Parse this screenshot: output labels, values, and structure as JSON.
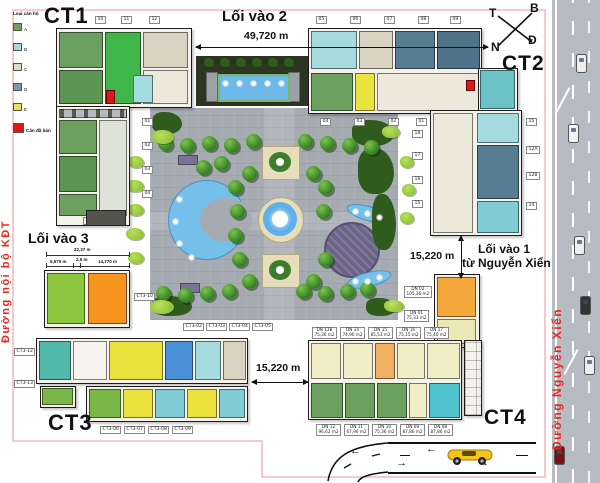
{
  "labels": {
    "ct1": "CT1",
    "ct2": "CT2",
    "ct3": "CT3",
    "ct4": "CT4"
  },
  "legend": {
    "title": "Loại căn hộ",
    "items": [
      {
        "label": "A",
        "color": "#6ca05e"
      },
      {
        "label": "B",
        "color": "#a5dade"
      },
      {
        "label": "C",
        "color": "#cfe0c4"
      },
      {
        "label": "D",
        "color": "#7d98a8"
      },
      {
        "label": "E",
        "color": "#e8e05a"
      },
      {
        "label": "Căn đã bán",
        "color": "#e01814"
      }
    ]
  },
  "compass": {
    "west": "T",
    "north": "B",
    "south": "N",
    "east": "Đ"
  },
  "streets": {
    "internal": "Đường nội bộ KĐT",
    "main": "Đường Nguyễn Xiển"
  },
  "entrances": {
    "e2": "Lối vào 2",
    "e3": "Lối vào 3",
    "e1_line1": "Lối vào 1",
    "e1_line2": "từ Nguyễn Xiển"
  },
  "dimensions": {
    "top_width": "49,720 m",
    "right_gap": "15,220 m",
    "bottom_gap": "15,220 m",
    "ct3_total": "22,37 m",
    "ct3_a": "5,570 m",
    "ct3_b": "2,5 m",
    "ct3_c": "14,770 m"
  },
  "ct1": {
    "right_chips": [
      "01",
      "02",
      "03",
      "04"
    ],
    "top_chips": [
      "10",
      "11",
      "12"
    ]
  },
  "ct2": {
    "top_chips": [
      "05",
      "06",
      "07",
      "08",
      "09"
    ],
    "bottom_chips": [
      "04",
      "03",
      "02",
      "01"
    ],
    "left_chips": [
      "18",
      "17",
      "16",
      "15"
    ],
    "right_chips": [
      "15",
      "12A",
      "12B",
      "14"
    ]
  },
  "ct3": {
    "left_chips": [
      "CT3-12",
      "CT3-13"
    ],
    "top_chips": [
      "CT3-02",
      "CT3-03",
      "CT3-04",
      "CT3-05"
    ],
    "bottom_chips": [
      "CT3-06",
      "CT3-07",
      "CT3-08",
      "CT3-09"
    ],
    "right_chip": "CT3-10"
  },
  "ct4": {
    "top_chips": [
      {
        "name": "DN 12B",
        "area": "75,36 m2"
      },
      {
        "name": "DN 14",
        "area": "74,90 m2"
      },
      {
        "name": "DN 15",
        "area": "85,53 m2"
      },
      {
        "name": "DN 16",
        "area": "75,15 m2"
      },
      {
        "name": "DN 17",
        "area": "75,40 m2"
      }
    ],
    "right_chips": [
      {
        "name": "DN 02",
        "area": "105,26 m2"
      },
      {
        "name": "DN 01",
        "area": "75,33 m2"
      }
    ],
    "bottom_chips": [
      {
        "name": "DN 12",
        "area": "96,62 m2"
      },
      {
        "name": "DN 11",
        "area": "67,96 m2"
      },
      {
        "name": "DN 10",
        "area": "75,36 m2"
      },
      {
        "name": "DN 09",
        "area": "87,86 m2"
      },
      {
        "name": "DN 08",
        "area": "87,86 m2"
      }
    ]
  }
}
